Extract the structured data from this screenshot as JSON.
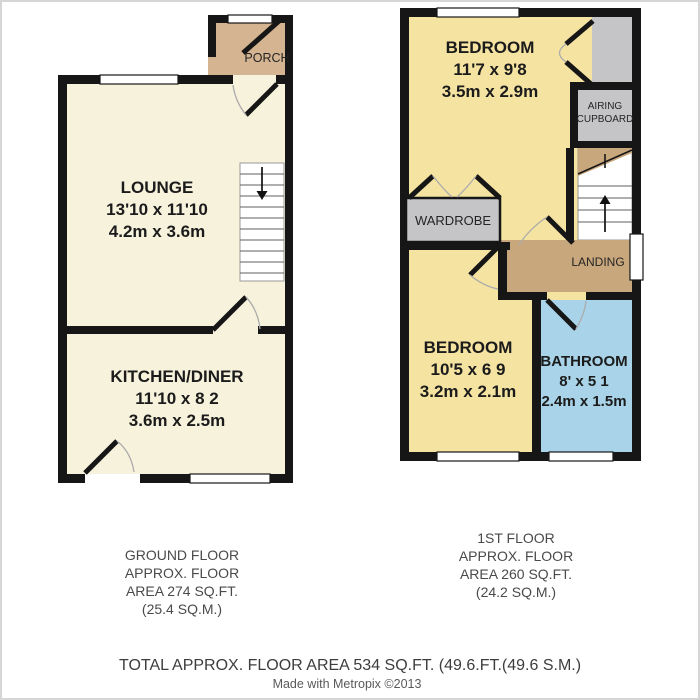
{
  "colors": {
    "wall": "#161616",
    "ground_room_cream": "#F7F2DC",
    "porch_tan": "#D5B491",
    "landing_tan": "#C9A77D",
    "bedroom_yellow": "#F5E3A2",
    "bathroom_blue": "#A8D3E8",
    "cupboard_gray": "#C5C5C7",
    "window_white": "#FFFFFF",
    "arc_gray": "#ABABAB"
  },
  "ground_floor": {
    "porch_label": "PORCH",
    "lounge": {
      "name": "LOUNGE",
      "imperial": "13'10 x 11'10",
      "metric": "4.2m x 3.6m"
    },
    "kitchen": {
      "name": "KITCHEN/DINER",
      "imperial": "11'10 x 8 2",
      "metric": "3.6m x 2.5m"
    },
    "caption": [
      "GROUND FLOOR",
      "APPROX. FLOOR",
      "AREA 274 SQ.FT.",
      "(25.4 SQ.M.)"
    ]
  },
  "first_floor": {
    "bedroom1": {
      "name": "BEDROOM",
      "imperial": "11'7 x 9'8",
      "metric": "3.5m x 2.9m"
    },
    "bedroom2": {
      "name": "BEDROOM",
      "imperial": "10'5 x 6 9",
      "metric": "3.2m x 2.1m"
    },
    "bathroom": {
      "name": "BATHROOM",
      "imperial": "8' x 5 1",
      "metric": "2.4m x 1.5m"
    },
    "wardrobe_label": "WARDROBE",
    "airing_cupboard_label": [
      "AIRING",
      "CUPBOARD"
    ],
    "landing_label": "LANDING",
    "caption": [
      "1ST FLOOR",
      "APPROX. FLOOR",
      "AREA 260 SQ.FT.",
      "(24.2 SQ.M.)"
    ]
  },
  "footer": {
    "total": "TOTAL APPROX. FLOOR AREA 534 SQ.FT. (49.6.FT.(49.6 S.M.)",
    "credit": "Made with Metropix ©2013"
  }
}
